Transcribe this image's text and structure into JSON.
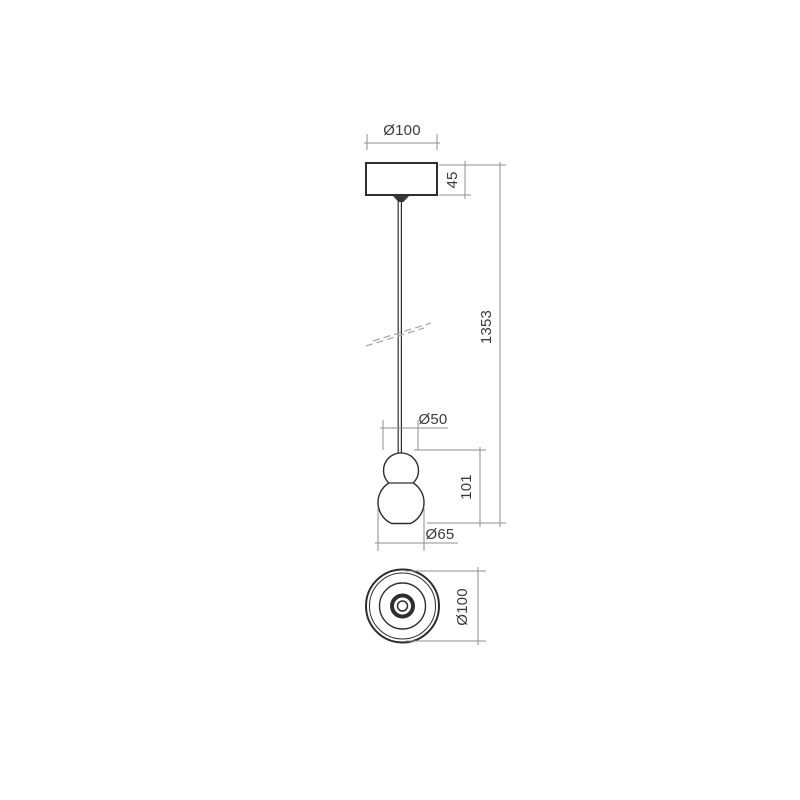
{
  "drawing": {
    "type": "technical-dimension-drawing",
    "subject": "pendant-lamp",
    "units": "mm",
    "front_view": {
      "labels": {
        "canopy_diameter": "Ø100",
        "canopy_height": "45",
        "suspension_length": "1353",
        "upper_sphere_diameter": "Ø50",
        "body_height": "101",
        "lower_sphere_diameter": "Ø65"
      }
    },
    "bottom_view": {
      "labels": {
        "overall_diameter": "Ø100"
      }
    },
    "colors": {
      "background": "#ffffff",
      "object_line": "#2e2e2e",
      "dimension_line": "#8f8f8f",
      "text": "#3c3c3c",
      "break_mark": "#aaaaaa"
    }
  }
}
